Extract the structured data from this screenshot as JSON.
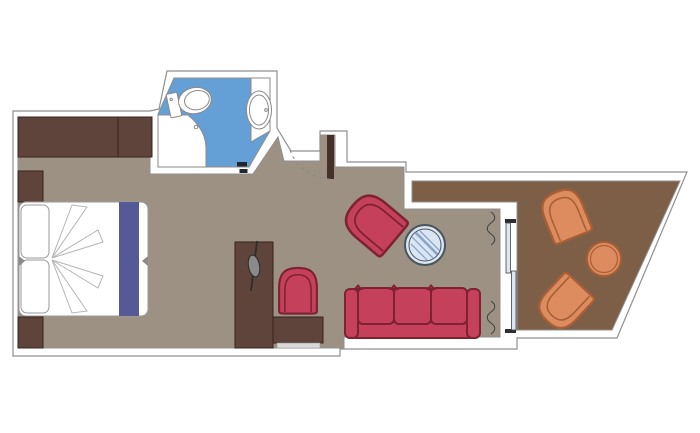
{
  "document": {
    "type": "floor-plan",
    "subject": "cabin-with-balcony-floor-plan",
    "rooms": [
      {
        "id": "bedroom-living",
        "floor": "taupe",
        "furniture": [
          "wardrobe",
          "bedside-table",
          "bedside-table",
          "double-bed",
          "pillow",
          "pillow",
          "bed-runner",
          "folded-blanket-fan",
          "tv-cabinet",
          "tv",
          "desk",
          "desk-drawer",
          "desk-chair",
          "armchair",
          "round-glass-table",
          "sofa-3-seater",
          "entry-door",
          "door-swing-arc",
          "curtain",
          "curtain"
        ]
      },
      {
        "id": "bathroom",
        "floor": "blue",
        "furniture": [
          "toilet",
          "washbasin-counter",
          "washbasin",
          "shower",
          "threshold-fitting"
        ]
      },
      {
        "id": "balcony",
        "floor": "dark-brown",
        "furniture": [
          "deck-chair",
          "deck-chair",
          "round-side-table",
          "sliding-glass-door"
        ]
      }
    ],
    "counts": {
      "beds": 1,
      "sofas": 1,
      "red-chairs": 2,
      "balcony-chairs": 2,
      "tables": 2,
      "doors": 2
    }
  },
  "colors": {
    "wall_outline": "#8f8f8f",
    "floor_main": "#9c9182",
    "floor_balcony": "#7d5f48",
    "floor_bath": "#649fd6",
    "wood": "#5e443a",
    "wood_outline": "#36241c",
    "door_leaf": "#46302a",
    "red": "#c5405a",
    "red_outline": "#7d2133",
    "orange": "#dc8c5e",
    "orange_outline": "#a95f36",
    "runner_purple": "#555a96",
    "glass_fill": "#dbe6f4",
    "glass_ring": "#4a545c",
    "glass_hatch": "#8aa4c8",
    "fixture_outline": "#8a8a8a",
    "bed_outline": "#9a9a9a",
    "blanket_line": "#b5b5b5",
    "light_strip": "#d9d9d9",
    "dark_fitting": "#20272e",
    "curtain": "#3f3f3f",
    "white": "#ffffff"
  }
}
